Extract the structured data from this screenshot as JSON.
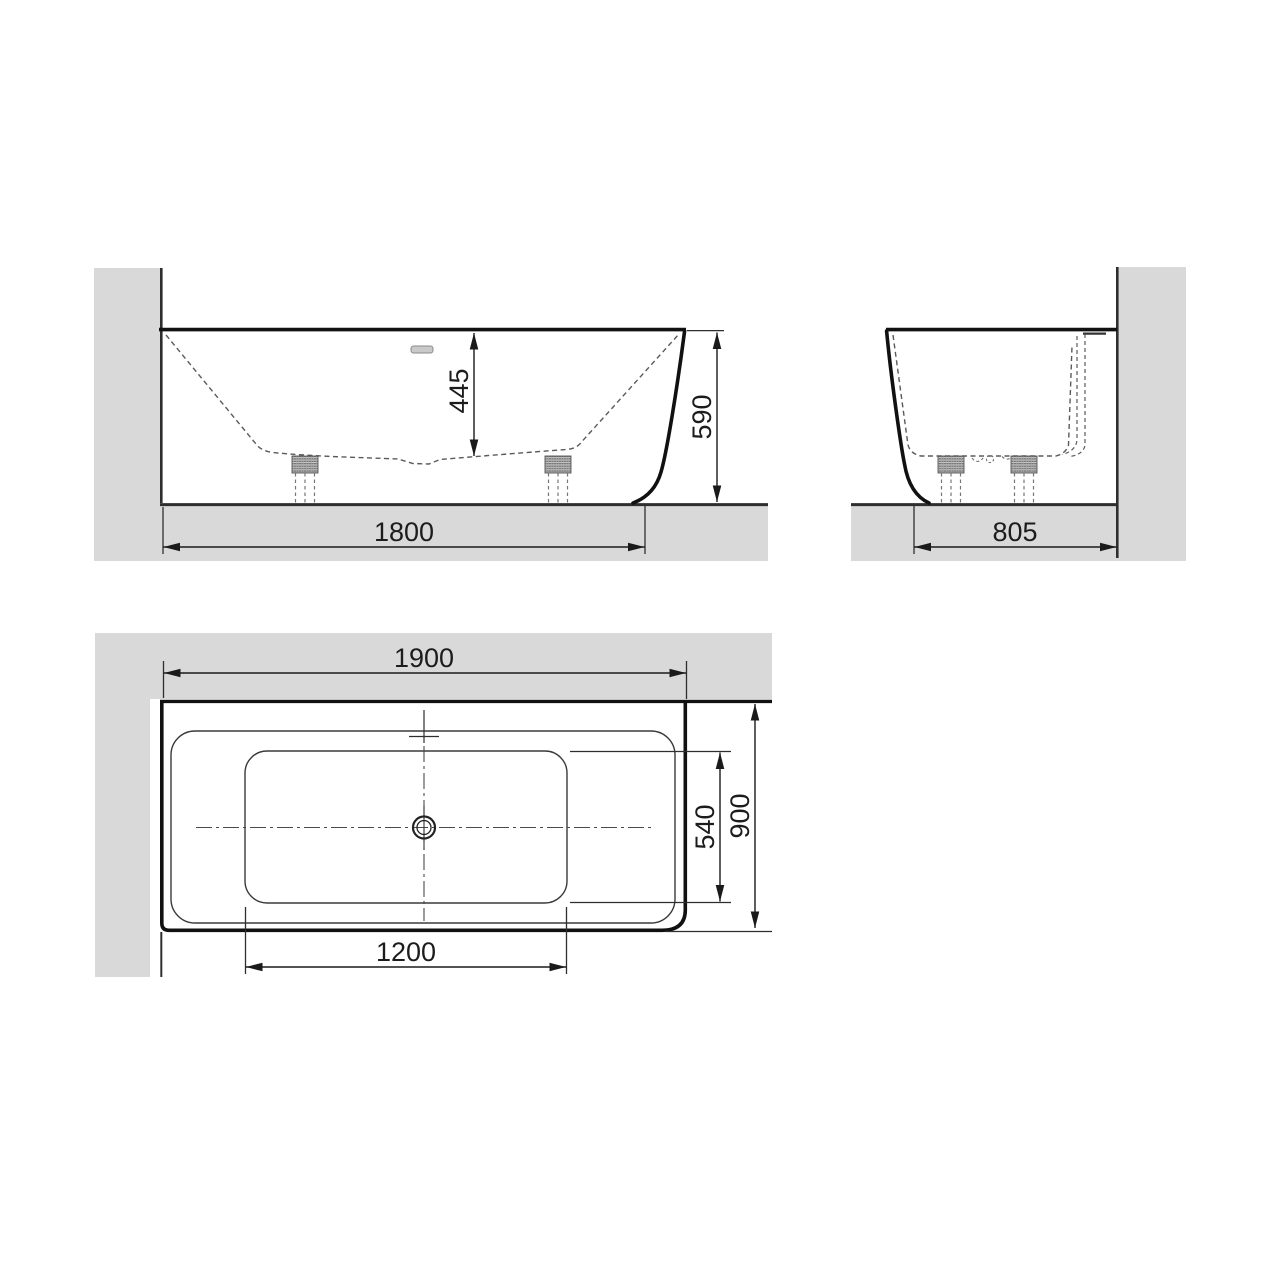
{
  "views": {
    "side": {
      "labels": {
        "inner_depth": "445",
        "overall_height": "590",
        "base_length": "1800"
      }
    },
    "end": {
      "labels": {
        "base_width": "805"
      }
    },
    "plan": {
      "labels": {
        "overall_length": "1900",
        "overall_width": "900",
        "basin_width": "540",
        "basin_length": "1200"
      }
    }
  },
  "colors": {
    "wall_fill": "#d9d9d9",
    "outline": "#1a1a1a",
    "thin_line": "#2e2e2e",
    "dashed_line": "#5a5a5a",
    "overflow_fill": "#c9c9c9"
  }
}
